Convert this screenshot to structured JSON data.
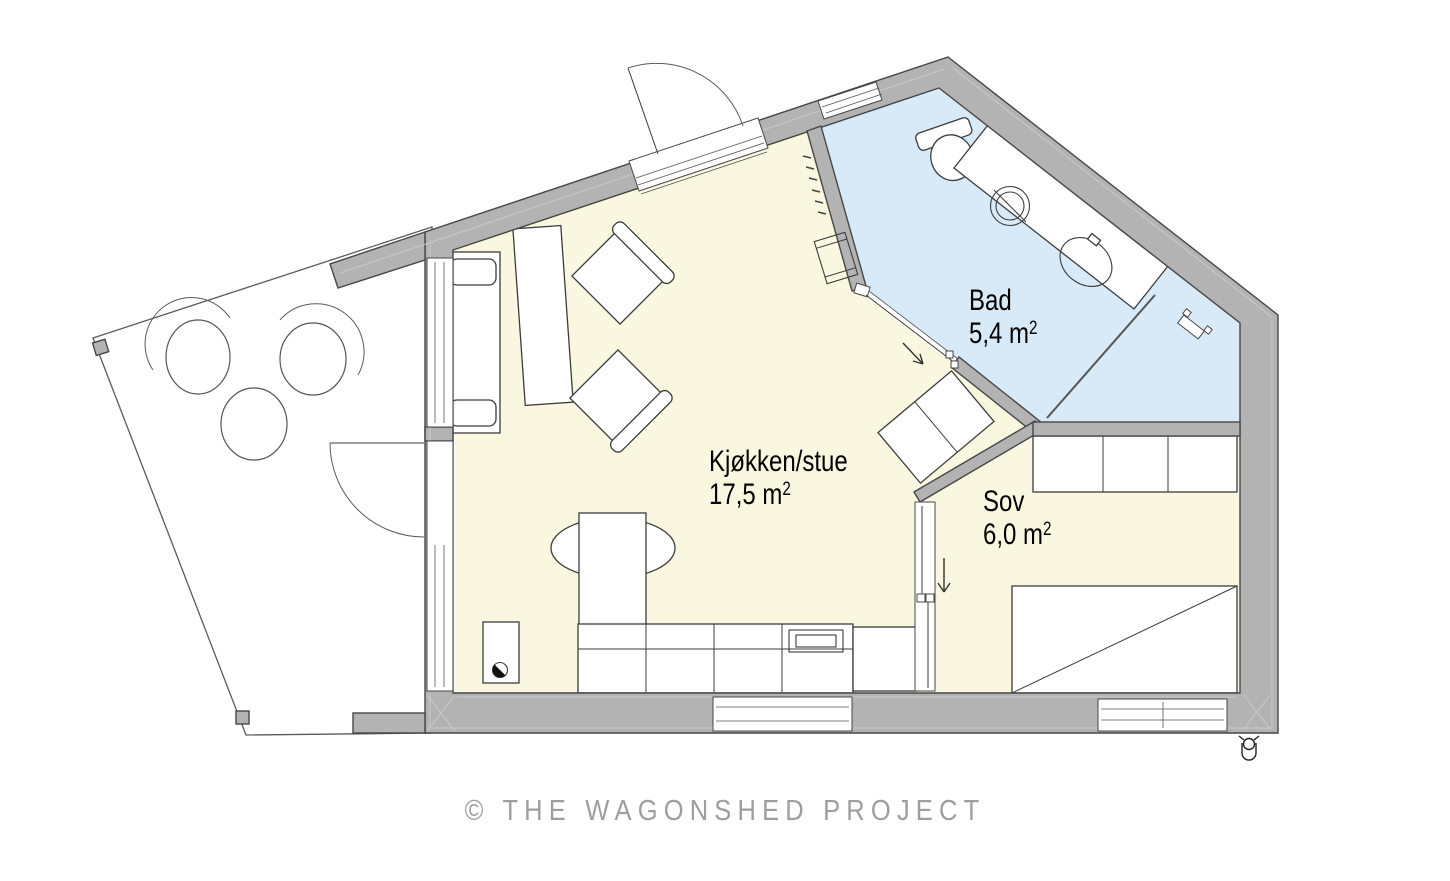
{
  "image": {
    "width": 1450,
    "height": 881,
    "background": "#ffffff"
  },
  "watermark": {
    "text": "© THE WAGONSHED PROJECT"
  },
  "rooms": [
    {
      "id": "kitchen-living",
      "name": "Kjøkken/stue",
      "area_text": "17,5 m",
      "area_sup": "2"
    },
    {
      "id": "bath",
      "name": "Bad",
      "area_text": "5,4 m",
      "area_sup": "2"
    },
    {
      "id": "bedroom",
      "name": "Sov",
      "area_text": "6,0 m",
      "area_sup": "2"
    }
  ],
  "colors": {
    "wall": "#b3b3b3",
    "wall_outline": "#474747",
    "floor_living": "#faf7e0",
    "floor_bath": "#d8e9f7",
    "floor_bedroom": "#faf7e0",
    "terrace_floor": "#ffffff",
    "fixture_line": "#3c3c3c",
    "watermark_text": "#9e9e9e"
  },
  "fixtures": {
    "kitchen_living": [
      "sofa",
      "shelf",
      "armchair",
      "armchair",
      "dining-table",
      "kitchen-counter",
      "cooktop",
      "fridge",
      "water-heater",
      "sideboard",
      "loft-ladder"
    ],
    "bath": [
      "toilet",
      "washing-machine",
      "washbasin",
      "shower-screen",
      "shower-head"
    ],
    "bedroom": [
      "wardrobe",
      "bed",
      "sliding-door"
    ],
    "terrace": [
      "chair",
      "chair",
      "round-table"
    ],
    "exterior": [
      "entrance-door",
      "terrace-door",
      "outdoor-tap"
    ]
  }
}
